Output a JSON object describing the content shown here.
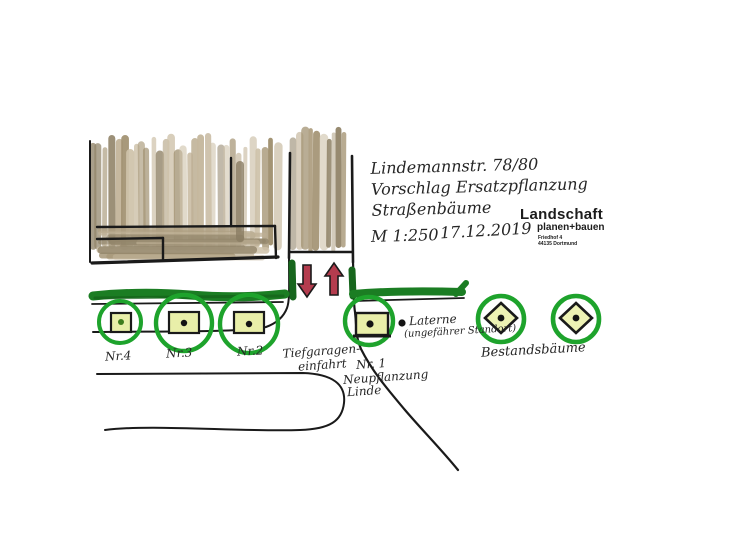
{
  "title_block": {
    "address": "Lindemannstr. 78/80",
    "subject_line1": "Vorschlag Ersatzpflanzung",
    "subject_line2": "Straßenbäume",
    "scale": "M 1:250",
    "date": "17.12.2019"
  },
  "logo": {
    "name": "Landschaft",
    "subtitle": "planen+bauen",
    "address_line1": "Friedhof 4",
    "address_line2": "44135 Dortmund"
  },
  "labels": {
    "tree4": "Nr.4",
    "tree3": "Nr.3",
    "tree2": "Nr.2",
    "tree1": "Nr. 1",
    "tree1_note1": "Neupflanzung",
    "tree1_note2": "Linde",
    "garage_line1": "Tiefgaragen-",
    "garage_line2": "einfahrt",
    "lantern_line1": "Laterne",
    "lantern_line2": "(ungefährer Standort)",
    "existing_trees": "Bestandsbäume"
  },
  "legend_semantics": {
    "green_circle_square": "Neupflanzung Straßenbaum (geplant)",
    "green_circle_diamond": "Bestandsbaum",
    "red_arrows": "Ein-/Ausfahrt Tiefgarage"
  },
  "colors": {
    "tree_circle_green": "#1ea32c",
    "green_strip": "#1b7d23",
    "square_fill": "#e9efa9",
    "diamond_fill": "#edf2b4",
    "arrow_red": "#b43c4e",
    "ink": "#1a1a1a",
    "building_tan": "#b0a184"
  }
}
